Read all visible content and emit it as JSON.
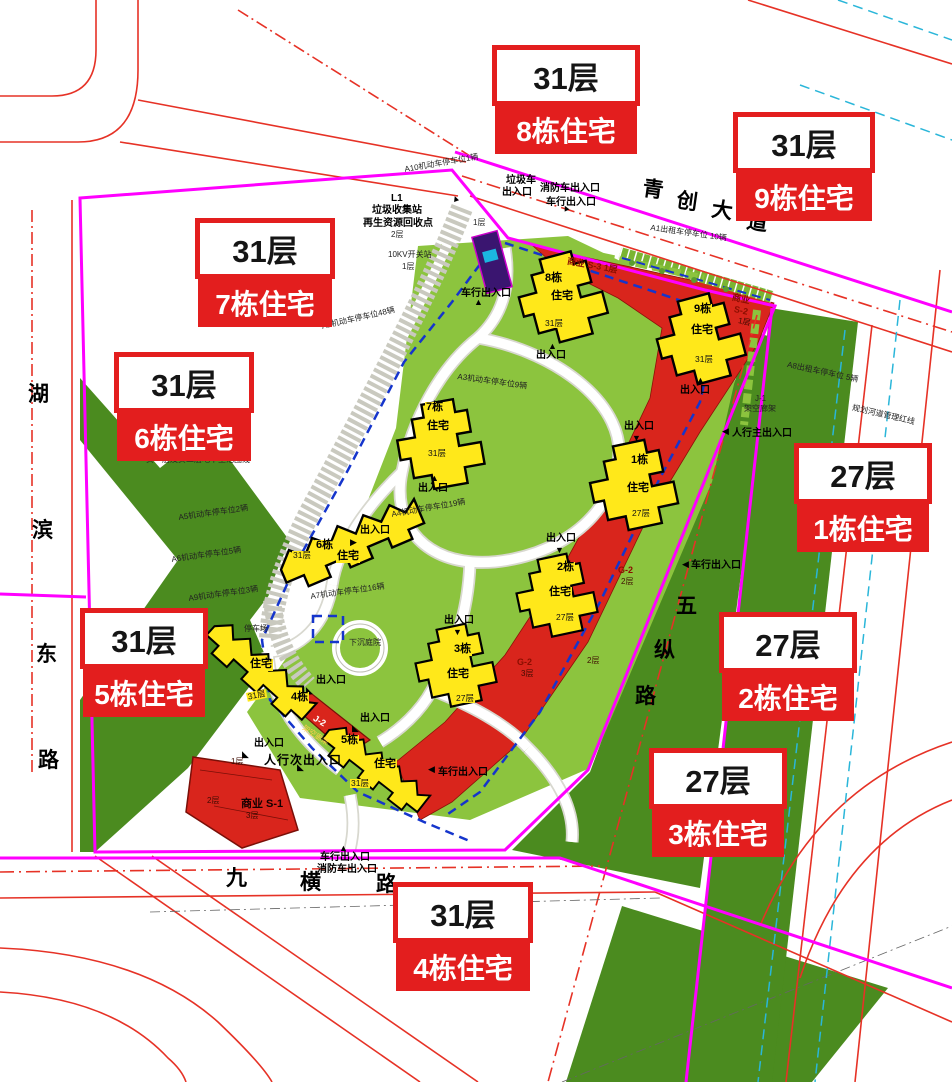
{
  "palette": {
    "site_green": "#8cc43e",
    "dark_green": "#4b8b1f",
    "building_yellow": "#ffe81a",
    "commercial_red": "#d9251c",
    "boundary_magenta": "#ff00ff",
    "dash_blue": "#1535cc",
    "dash_cyan": "#2ab6d9",
    "road_red": "#e63226",
    "callout_red": "#e31e1e",
    "utility_purple": "#3a1570"
  },
  "callouts": [
    {
      "floors": "31层",
      "name": "8栋住宅",
      "x": 492,
      "y": 45,
      "w": 148
    },
    {
      "floors": "31层",
      "name": "9栋住宅",
      "x": 733,
      "y": 112,
      "w": 142
    },
    {
      "floors": "31层",
      "name": "7栋住宅",
      "x": 195,
      "y": 218,
      "w": 140
    },
    {
      "floors": "31层",
      "name": "6栋住宅",
      "x": 114,
      "y": 352,
      "w": 140
    },
    {
      "floors": "27层",
      "name": "1栋住宅",
      "x": 794,
      "y": 443,
      "w": 138
    },
    {
      "floors": "27层",
      "name": "2栋住宅",
      "x": 719,
      "y": 612,
      "w": 138
    },
    {
      "floors": "27层",
      "name": "3栋住宅",
      "x": 649,
      "y": 748,
      "w": 138
    },
    {
      "floors": "31层",
      "name": "5栋住宅",
      "x": 80,
      "y": 608,
      "w": 128
    },
    {
      "floors": "31层",
      "name": "4栋住宅",
      "x": 393,
      "y": 882,
      "w": 140
    }
  ],
  "roads": [
    {
      "name": "青创大道",
      "chars": [
        [
          645,
          172
        ],
        [
          679,
          184
        ],
        [
          714,
          193
        ],
        [
          749,
          205
        ]
      ],
      "rot": 8
    },
    {
      "name": "湖滨东路",
      "chars": [
        [
          28,
          378
        ],
        [
          32,
          514
        ],
        [
          36,
          638
        ],
        [
          38,
          744
        ]
      ],
      "rot": 0
    },
    {
      "name": "九横路",
      "chars": [
        [
          226,
          862
        ],
        [
          300,
          866
        ],
        [
          376,
          868
        ]
      ],
      "rot": 0
    },
    {
      "name": "五纵路",
      "chars": [
        [
          676,
          590
        ],
        [
          654,
          634
        ],
        [
          635,
          680
        ]
      ],
      "rot": 0
    }
  ],
  "labels": [
    {
      "t": "A10机动车停车位1辆",
      "x": 404,
      "y": 166,
      "c": "pk",
      "r": -10,
      "n": "parking-a10"
    },
    {
      "t": "垃圾车",
      "x": 506,
      "y": 176,
      "c": "ent",
      "n": "garbage-truck-exit"
    },
    {
      "t": "出入口",
      "x": 502,
      "y": 188,
      "c": "ent",
      "n": "garbage-truck-exit"
    },
    {
      "t": "▲",
      "x": 450,
      "y": 196,
      "c": "tri",
      "r": -20
    },
    {
      "t": "消防车出入口",
      "x": 540,
      "y": 184,
      "c": "ent",
      "n": "fire-truck-entrance"
    },
    {
      "t": "车行出入口",
      "x": 546,
      "y": 198,
      "c": "ent",
      "n": "vehicle-entrance-north"
    },
    {
      "t": "▲",
      "x": 560,
      "y": 206,
      "c": "tri",
      "r": -25
    },
    {
      "t": "L1",
      "x": 391,
      "y": 194,
      "c": "ent",
      "n": "garbage-station"
    },
    {
      "t": "垃圾收集站",
      "x": 372,
      "y": 206,
      "c": "ent",
      "n": "garbage-station"
    },
    {
      "t": "再生资源回收点",
      "x": 363,
      "y": 219,
      "c": "ent",
      "n": "recycle-point"
    },
    {
      "t": "2层",
      "x": 391,
      "y": 231,
      "c": "pk"
    },
    {
      "t": "1层",
      "x": 473,
      "y": 219,
      "c": "pk"
    },
    {
      "t": "10KV开关站",
      "x": 388,
      "y": 251,
      "c": "pk",
      "n": "switch-station"
    },
    {
      "t": "1层",
      "x": 402,
      "y": 263,
      "c": "pk"
    },
    {
      "t": "车行出入口",
      "x": 461,
      "y": 289,
      "c": "ent",
      "n": "vehicle-entrance-west"
    },
    {
      "t": "▲",
      "x": 474,
      "y": 298,
      "c": "tri"
    },
    {
      "t": "A1出租车停车位 10辆",
      "x": 651,
      "y": 224,
      "c": "pk",
      "r": 8,
      "n": "parking-a1"
    },
    {
      "t": "商业 S-3 1层",
      "x": 568,
      "y": 257,
      "c": "com",
      "r": 10,
      "n": "commercial-s3"
    },
    {
      "t": "8栋",
      "x": 544,
      "y": 273,
      "c": "tag",
      "n": "building-8-tag"
    },
    {
      "t": "住宅",
      "x": 550,
      "y": 291,
      "c": "tag"
    },
    {
      "t": "31层",
      "x": 544,
      "y": 319,
      "c": "tag-s"
    },
    {
      "t": "▲",
      "x": 548,
      "y": 342,
      "c": "tri"
    },
    {
      "t": "出入口",
      "x": 536,
      "y": 351,
      "c": "ent"
    },
    {
      "t": "9栋",
      "x": 693,
      "y": 304,
      "c": "tag",
      "n": "building-9-tag"
    },
    {
      "t": "住宅",
      "x": 690,
      "y": 325,
      "c": "tag"
    },
    {
      "t": "31层",
      "x": 694,
      "y": 355,
      "c": "tag-s"
    },
    {
      "t": "▲",
      "x": 696,
      "y": 376,
      "c": "tri"
    },
    {
      "t": "出入口",
      "x": 680,
      "y": 386,
      "c": "ent"
    },
    {
      "t": "商业",
      "x": 733,
      "y": 293,
      "c": "com",
      "r": 12,
      "n": "commercial-s2"
    },
    {
      "t": "S-2",
      "x": 735,
      "y": 305,
      "c": "com",
      "r": 12
    },
    {
      "t": "1层",
      "x": 739,
      "y": 317,
      "c": "com-s",
      "r": 12
    },
    {
      "t": "A8出租车停车位 5辆",
      "x": 788,
      "y": 361,
      "c": "pk",
      "r": 12,
      "n": "parking-a8"
    },
    {
      "t": "J-1",
      "x": 755,
      "y": 395,
      "c": "pk",
      "n": "corridor-j1"
    },
    {
      "t": "架空廊架",
      "x": 744,
      "y": 405,
      "c": "pk"
    },
    {
      "t": "◀",
      "x": 722,
      "y": 427,
      "c": "tri"
    },
    {
      "t": "人行主出入口",
      "x": 732,
      "y": 429,
      "c": "ent",
      "n": "main-pedestrian-entrance"
    },
    {
      "t": "规划河道管理红线",
      "x": 853,
      "y": 404,
      "c": "pk",
      "r": 13,
      "n": "river-redline"
    },
    {
      "t": "A2机动车停车位48辆",
      "x": 321,
      "y": 323,
      "c": "pk",
      "r": -13,
      "n": "parking-a2"
    },
    {
      "t": "A3机动车停车位9辆",
      "x": 458,
      "y": 373,
      "c": "pk",
      "r": 8,
      "n": "parking-a3"
    },
    {
      "t": "7栋",
      "x": 425,
      "y": 402,
      "c": "tag",
      "n": "building-7-tag"
    },
    {
      "t": "住宅",
      "x": 426,
      "y": 421,
      "c": "tag"
    },
    {
      "t": "31层",
      "x": 427,
      "y": 449,
      "c": "tag-s"
    },
    {
      "t": "▲",
      "x": 430,
      "y": 474,
      "c": "tri"
    },
    {
      "t": "出入口",
      "x": 418,
      "y": 484,
      "c": "ent"
    },
    {
      "t": "负一层及负二层地下室范围线",
      "x": 146,
      "y": 456,
      "c": "pk",
      "n": "basement-boundary"
    },
    {
      "t": "A5机动车停车位2辆",
      "x": 178,
      "y": 514,
      "c": "pk",
      "r": -8,
      "n": "parking-a5"
    },
    {
      "t": "A4机动车停车位19辆",
      "x": 391,
      "y": 511,
      "c": "pk",
      "r": -10,
      "n": "parking-a4"
    },
    {
      "t": "A6机动车停车位5辆",
      "x": 171,
      "y": 556,
      "c": "pk",
      "r": -8,
      "n": "parking-a6"
    },
    {
      "t": "31层",
      "x": 292,
      "y": 551,
      "c": "tag-s"
    },
    {
      "t": "6栋",
      "x": 315,
      "y": 540,
      "c": "tag",
      "n": "building-6-tag"
    },
    {
      "t": "住宅",
      "x": 336,
      "y": 551,
      "c": "tag"
    },
    {
      "t": "出入口",
      "x": 360,
      "y": 526,
      "c": "ent"
    },
    {
      "t": "▶",
      "x": 350,
      "y": 538,
      "c": "tri"
    },
    {
      "t": "A9机动车停车位3辆",
      "x": 188,
      "y": 595,
      "c": "pk",
      "r": -8,
      "n": "parking-a9"
    },
    {
      "t": "A7机动车停车位16辆",
      "x": 310,
      "y": 593,
      "c": "pk",
      "r": -8,
      "n": "parking-a7"
    },
    {
      "t": "停车场",
      "x": 244,
      "y": 625,
      "c": "pk",
      "n": "parking-lot"
    },
    {
      "t": "下沉庭院",
      "x": 349,
      "y": 639,
      "c": "pk",
      "n": "sunken-courtyard"
    },
    {
      "t": "出入口",
      "x": 624,
      "y": 422,
      "c": "ent"
    },
    {
      "t": "▼",
      "x": 632,
      "y": 434,
      "c": "tri"
    },
    {
      "t": "1栋",
      "x": 630,
      "y": 455,
      "c": "tag",
      "n": "building-1-tag"
    },
    {
      "t": "住宅",
      "x": 626,
      "y": 483,
      "c": "tag"
    },
    {
      "t": "27层",
      "x": 631,
      "y": 509,
      "c": "tag-s"
    },
    {
      "t": "◀",
      "x": 682,
      "y": 560,
      "c": "tri"
    },
    {
      "t": "车行出入口",
      "x": 691,
      "y": 561,
      "c": "ent",
      "n": "vehicle-entrance-east"
    },
    {
      "t": "G-2",
      "x": 618,
      "y": 566,
      "c": "com",
      "n": "garage-g2-upper"
    },
    {
      "t": "2层",
      "x": 621,
      "y": 578,
      "c": "com-s"
    },
    {
      "t": "出入口",
      "x": 546,
      "y": 534,
      "c": "ent"
    },
    {
      "t": "▼",
      "x": 555,
      "y": 546,
      "c": "tri"
    },
    {
      "t": "2栋",
      "x": 556,
      "y": 562,
      "c": "tag",
      "n": "building-2-tag"
    },
    {
      "t": "住宅",
      "x": 548,
      "y": 587,
      "c": "tag"
    },
    {
      "t": "27层",
      "x": 555,
      "y": 613,
      "c": "tag-s"
    },
    {
      "t": "2层",
      "x": 587,
      "y": 657,
      "c": "com-s"
    },
    {
      "t": "G-2",
      "x": 517,
      "y": 658,
      "c": "com",
      "n": "garage-g2-lower"
    },
    {
      "t": "3层",
      "x": 521,
      "y": 670,
      "c": "com-s"
    },
    {
      "t": "出入口",
      "x": 444,
      "y": 616,
      "c": "ent"
    },
    {
      "t": "▼",
      "x": 453,
      "y": 628,
      "c": "tri"
    },
    {
      "t": "3栋",
      "x": 453,
      "y": 644,
      "c": "tag",
      "n": "building-3-tag"
    },
    {
      "t": "住宅",
      "x": 446,
      "y": 669,
      "c": "tag"
    },
    {
      "t": "27层",
      "x": 455,
      "y": 694,
      "c": "tag-s"
    },
    {
      "t": "出入口",
      "x": 316,
      "y": 676,
      "c": "ent"
    },
    {
      "t": "◣",
      "x": 306,
      "y": 686,
      "c": "tri"
    },
    {
      "t": "住宅",
      "x": 249,
      "y": 659,
      "c": "tag"
    },
    {
      "t": "31层",
      "x": 246,
      "y": 693,
      "c": "tag-s",
      "r": -12
    },
    {
      "t": "4栋",
      "x": 290,
      "y": 692,
      "c": "tag",
      "n": "building-4-tag"
    },
    {
      "t": "J-2",
      "x": 316,
      "y": 714,
      "c": "comw",
      "r": 30,
      "n": "corridor-j2"
    },
    {
      "t": "架空廊架",
      "x": 305,
      "y": 724,
      "c": "comy",
      "r": 33
    },
    {
      "t": "出入口",
      "x": 360,
      "y": 714,
      "c": "ent"
    },
    {
      "t": "◣",
      "x": 352,
      "y": 724,
      "c": "tri"
    },
    {
      "t": "5栋",
      "x": 340,
      "y": 735,
      "c": "tag",
      "n": "building-5-tag"
    },
    {
      "t": "住宅",
      "x": 373,
      "y": 759,
      "c": "tag"
    },
    {
      "t": "31层",
      "x": 350,
      "y": 779,
      "c": "tag-s"
    },
    {
      "t": "出入口",
      "x": 254,
      "y": 739,
      "c": "ent"
    },
    {
      "t": "◣",
      "x": 242,
      "y": 750,
      "c": "tri"
    },
    {
      "t": "◣",
      "x": 297,
      "y": 763,
      "c": "tri"
    },
    {
      "t": "人行次出入口",
      "x": 264,
      "y": 754,
      "c": "ent-b",
      "n": "secondary-pedestrian-entrance"
    },
    {
      "t": "1层",
      "x": 231,
      "y": 758,
      "c": "com-s"
    },
    {
      "t": "2层",
      "x": 207,
      "y": 797,
      "c": "com-s"
    },
    {
      "t": "商业 S-1",
      "x": 241,
      "y": 799,
      "c": "com-b",
      "n": "commercial-s1"
    },
    {
      "t": "3层",
      "x": 246,
      "y": 812,
      "c": "com-s"
    },
    {
      "t": "◀",
      "x": 428,
      "y": 765,
      "c": "tri"
    },
    {
      "t": "车行出入口",
      "x": 438,
      "y": 768,
      "c": "ent",
      "n": "vehicle-entrance-southeast"
    },
    {
      "t": "▲",
      "x": 339,
      "y": 844,
      "c": "tri"
    },
    {
      "t": "车行出入口",
      "x": 320,
      "y": 853,
      "c": "ent",
      "n": "vehicle-entrance-south"
    },
    {
      "t": "消防车出入口",
      "x": 317,
      "y": 865,
      "c": "ent",
      "n": "fire-entrance-south"
    }
  ]
}
